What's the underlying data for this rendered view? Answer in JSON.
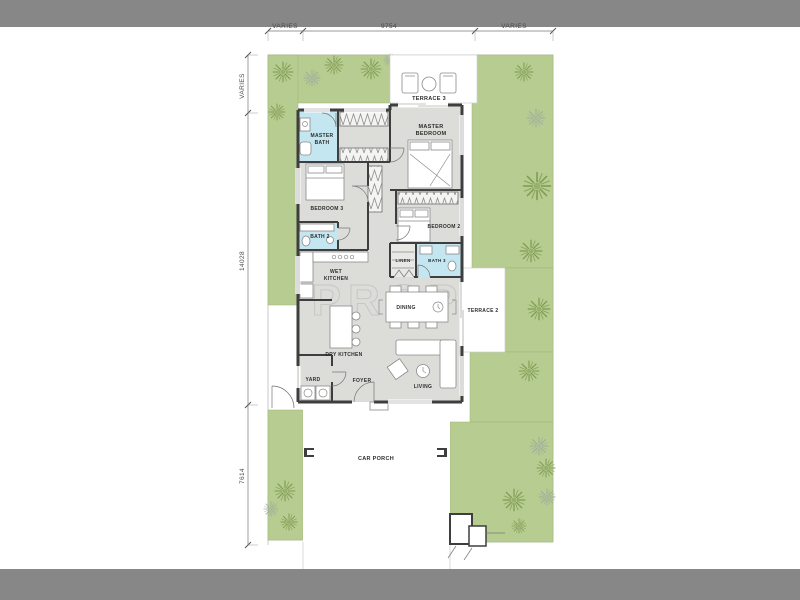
{
  "colors": {
    "bar": "#878787",
    "garden": "#b7cc90",
    "garden_edge": "#9db377",
    "floor": "#dcdcd9",
    "wall": "#3e3e3e",
    "bath": "#c4e6f0",
    "tree_green": "#7d9a50",
    "tree_gray": "#9cab9e",
    "label": "#2e2e2e",
    "dim": "#4a4a4a",
    "furn": "#8a8a8a",
    "watermark": "#9a9a9a"
  },
  "watermark": "PROP",
  "dimensions": {
    "top_left": "VARIES",
    "top_mid": "9754",
    "top_right": "VARIES",
    "left_top": "VARIES",
    "left_mid": "14028",
    "left_bottom": "7614"
  },
  "rooms": {
    "terrace3": "TERRACE 3",
    "master_bedroom": [
      "MASTER",
      "BEDROOM"
    ],
    "master_bath": [
      "MASTER",
      "BATH"
    ],
    "bedroom3": "BEDROOM 3",
    "bedroom2": "BEDROOM 2",
    "bath2": "BATH 2",
    "wet_kitchen": [
      "WET",
      "KITCHEN"
    ],
    "linen": "LINEN",
    "bath3": "BATH 3",
    "dining": "DINING",
    "terrace2": "TERRACE 2",
    "dry_kitchen": "DRY KITCHEN",
    "living": "LIVING",
    "foyer": "FOYER",
    "yard": "YARD",
    "car_porch": "CAR PORCH"
  }
}
